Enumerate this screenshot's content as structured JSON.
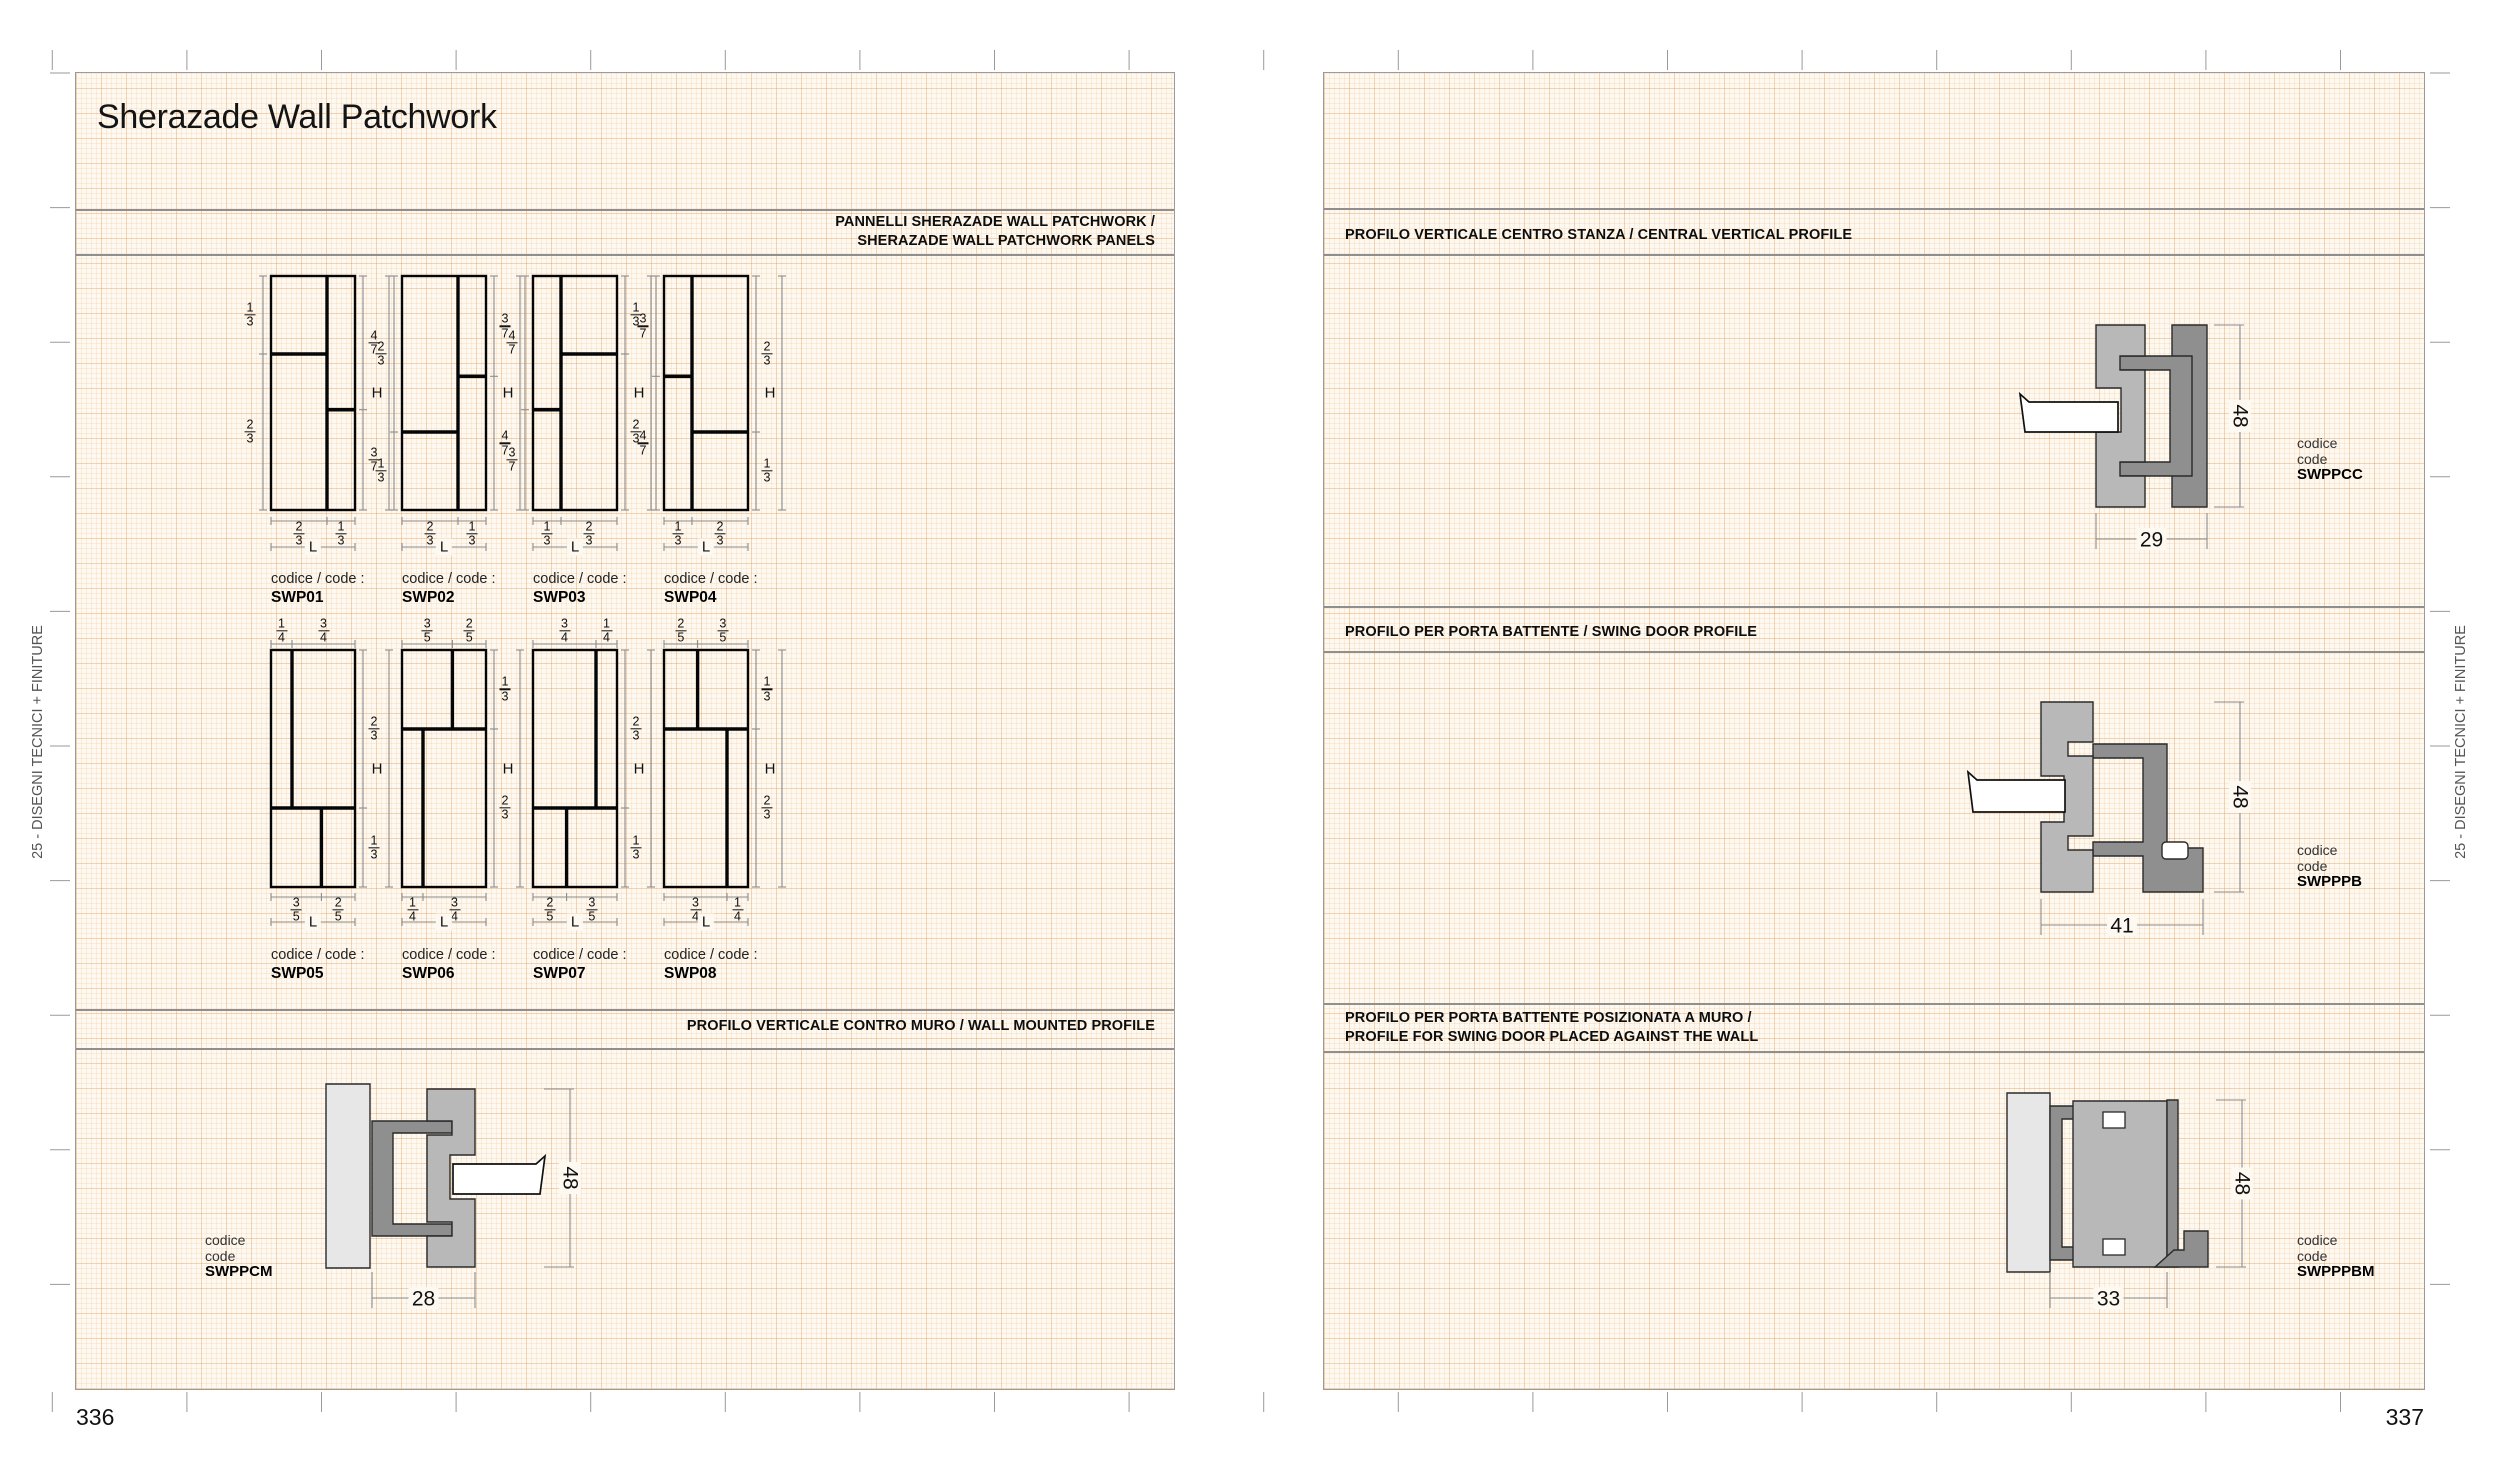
{
  "margin_label": "25 - DISEGNI TECNICI + FINITURE",
  "page_left": {
    "number": "336",
    "title": "Sherazade Wall Patchwork",
    "section1_heading": [
      "PANNELLI SHERAZADE WALL PATCHWORK /",
      "SHERAZADE WALL PATCHWORK PANELS"
    ],
    "section2_heading": [
      "PROFILO VERTICALE CONTRO MURO / WALL MOUNTED PROFILE"
    ],
    "code_prefix": "codice / code :",
    "height_label": "H",
    "length_label": "L",
    "panels": [
      {
        "code": "SWP01",
        "row": 1,
        "v": 0.6667,
        "yl": 0.3333,
        "yr": 0.5714,
        "dims": {
          "left": [
            "1/3",
            "2/3"
          ],
          "right": [
            "4/7",
            "3/7"
          ],
          "bottom": [
            "2/3",
            "1/3"
          ]
        }
      },
      {
        "code": "SWP02",
        "row": 1,
        "v": 0.6667,
        "yl": 0.6667,
        "yr": 0.4286,
        "dims": {
          "left": [
            "2/3",
            "1/3"
          ],
          "right": [
            "3/7",
            "4/7"
          ],
          "bottom": [
            "2/3",
            "1/3"
          ]
        }
      },
      {
        "code": "SWP03",
        "row": 1,
        "v": 0.3333,
        "yl": 0.5714,
        "yr": 0.3333,
        "dims": {
          "left": [
            "4/7",
            "3/7"
          ],
          "right": [
            "1/3",
            "2/3"
          ],
          "bottom": [
            "1/3",
            "2/3"
          ]
        }
      },
      {
        "code": "SWP04",
        "row": 1,
        "v": 0.3333,
        "yl": 0.4286,
        "yr": 0.6667,
        "dims": {
          "left": [
            "3/7",
            "4/7"
          ],
          "right": [
            "2/3",
            "1/3"
          ],
          "bottom": [
            "1/3",
            "2/3"
          ]
        }
      },
      {
        "code": "SWP05",
        "row": 2,
        "xt": 0.25,
        "yh": 0.6667,
        "xb": 0.6,
        "dims": {
          "top": [
            "1/4",
            "3/4"
          ],
          "right": [
            "2/3",
            "1/3"
          ],
          "bottom": [
            "3/5",
            "2/5"
          ]
        }
      },
      {
        "code": "SWP06",
        "row": 2,
        "xt": 0.6,
        "yh": 0.3333,
        "xb": 0.25,
        "dims": {
          "top": [
            "3/5",
            "2/5"
          ],
          "right": [
            "1/3",
            "2/3"
          ],
          "bottom": [
            "1/4",
            "3/4"
          ]
        }
      },
      {
        "code": "SWP07",
        "row": 2,
        "xt": 0.75,
        "yh": 0.6667,
        "xb": 0.4,
        "dims": {
          "top": [
            "3/4",
            "1/4"
          ],
          "right": [
            "2/3",
            "1/3"
          ],
          "bottom": [
            "2/5",
            "3/5"
          ]
        }
      },
      {
        "code": "SWP08",
        "row": 2,
        "xt": 0.4,
        "yh": 0.3333,
        "xb": 0.75,
        "dims": {
          "top": [
            "2/5",
            "3/5"
          ],
          "right": [
            "1/3",
            "2/3"
          ],
          "bottom": [
            "3/4",
            "1/4"
          ]
        }
      }
    ],
    "profile": {
      "code_lines": [
        "codice",
        "code"
      ],
      "code": "SWPPCM",
      "width": "28",
      "height": "48"
    }
  },
  "page_right": {
    "number": "337",
    "section_headings": [
      [
        "PROFILO VERTICALE CENTRO STANZA / CENTRAL VERTICAL PROFILE"
      ],
      [
        "PROFILO PER PORTA BATTENTE / SWING DOOR PROFILE"
      ],
      [
        "PROFILO PER PORTA BATTENTE POSIZIONATA A MURO /",
        "PROFILE FOR SWING DOOR PLACED AGAINST THE WALL"
      ]
    ],
    "profiles": [
      {
        "code_lines": [
          "codice",
          "code"
        ],
        "code": "SWPPCC",
        "width": "29",
        "height": "48"
      },
      {
        "code_lines": [
          "codice",
          "code"
        ],
        "code": "SWPPPB",
        "width": "41",
        "height": "48"
      },
      {
        "code_lines": [
          "codice",
          "code"
        ],
        "code": "SWPPPBM",
        "width": "33",
        "height": "48"
      }
    ]
  }
}
